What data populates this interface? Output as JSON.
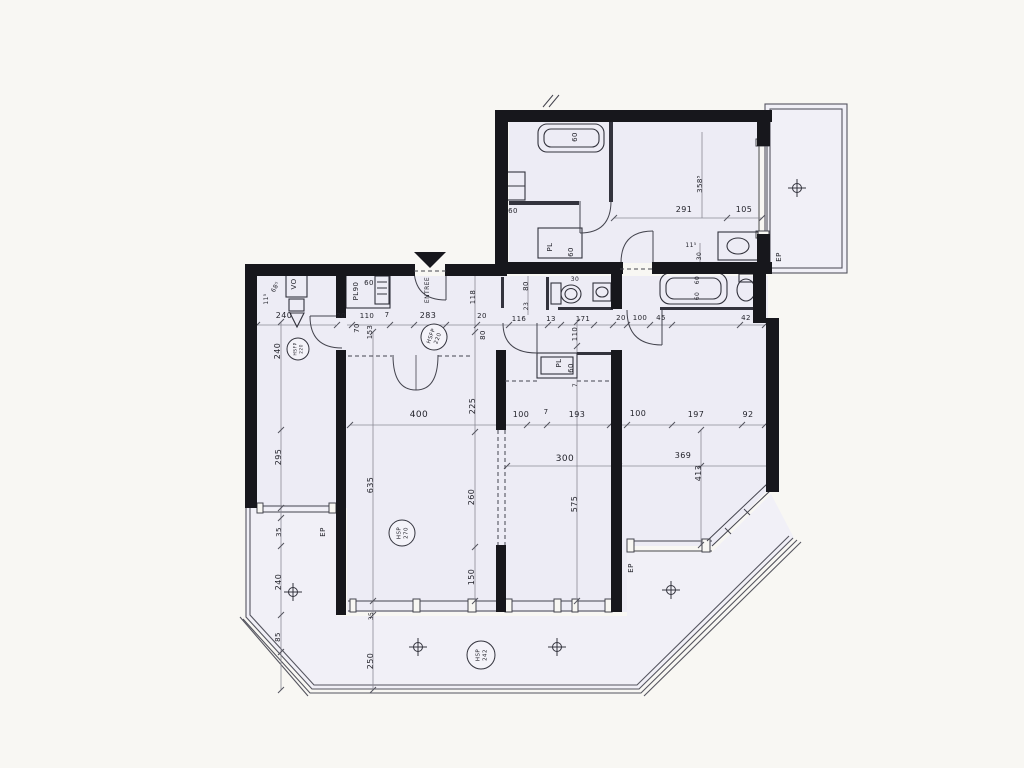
{
  "document": {
    "kind": "scanned apartment floor plan"
  },
  "colors": {
    "paper": "#f8f7f3",
    "room_fill": "#edecf5",
    "balcony_fill": "#f1f0f7",
    "wall": "#17171c",
    "line": "#44444e",
    "dim_line": "#8a8a95",
    "text": "#23232b",
    "watermark": "#7d7d88"
  },
  "plan": {
    "labels": [
      {
        "text": "60",
        "x": 577,
        "y": 137,
        "r": -90,
        "s": 7
      },
      {
        "text": "60",
        "x": 513,
        "y": 213,
        "r": 0,
        "s": 7
      },
      {
        "text": "PL",
        "x": 552,
        "y": 247,
        "r": -90,
        "s": 7
      },
      {
        "text": "60",
        "x": 573,
        "y": 252,
        "r": -90,
        "s": 7
      },
      {
        "text": "358⁵",
        "x": 702,
        "y": 184,
        "r": -90,
        "s": 7
      },
      {
        "text": "291",
        "x": 684,
        "y": 212,
        "r": 0,
        "s": 8
      },
      {
        "text": "105",
        "x": 744,
        "y": 212,
        "r": 0,
        "s": 8
      },
      {
        "text": "11⁵",
        "x": 691,
        "y": 247,
        "r": 0,
        "s": 6
      },
      {
        "text": "30",
        "x": 701,
        "y": 256,
        "r": -90,
        "s": 6
      },
      {
        "text": "EP",
        "x": 781,
        "y": 257,
        "r": -90,
        "s": 7
      },
      {
        "text": "60",
        "x": 699,
        "y": 280,
        "r": -90,
        "s": 6
      },
      {
        "text": "60",
        "x": 699,
        "y": 296,
        "r": -90,
        "s": 6
      },
      {
        "text": "30",
        "x": 575,
        "y": 281,
        "r": 0,
        "s": 6
      },
      {
        "text": "240",
        "x": 284,
        "y": 318,
        "r": 0,
        "s": 8
      },
      {
        "text": "20",
        "x": 341,
        "y": 318,
        "r": 0,
        "s": 7
      },
      {
        "text": "110",
        "x": 367,
        "y": 318,
        "r": 0,
        "s": 7
      },
      {
        "text": "7",
        "x": 387,
        "y": 317,
        "r": 0,
        "s": 7
      },
      {
        "text": "283",
        "x": 428,
        "y": 318,
        "r": 0,
        "s": 8
      },
      {
        "text": "20",
        "x": 482,
        "y": 318,
        "r": 0,
        "s": 7
      },
      {
        "text": "116",
        "x": 519,
        "y": 321,
        "r": 0,
        "s": 7
      },
      {
        "text": "13",
        "x": 551,
        "y": 321,
        "r": 0,
        "s": 7
      },
      {
        "text": "171",
        "x": 583,
        "y": 321,
        "r": 0,
        "s": 7
      },
      {
        "text": "20",
        "x": 621,
        "y": 320,
        "r": 0,
        "s": 7
      },
      {
        "text": "100",
        "x": 640,
        "y": 320,
        "r": 0,
        "s": 7
      },
      {
        "text": "45",
        "x": 661,
        "y": 320,
        "r": 0,
        "s": 7
      },
      {
        "text": "42",
        "x": 746,
        "y": 320,
        "r": 0,
        "s": 7
      },
      {
        "text": "70",
        "x": 359,
        "y": 328,
        "r": -90,
        "s": 7
      },
      {
        "text": "153",
        "x": 372,
        "y": 332,
        "r": -90,
        "s": 7
      },
      {
        "text": "118",
        "x": 475,
        "y": 297,
        "r": -90,
        "s": 7
      },
      {
        "text": "80",
        "x": 485,
        "y": 335,
        "r": -90,
        "s": 7
      },
      {
        "text": "80",
        "x": 528,
        "y": 286,
        "r": -90,
        "s": 7
      },
      {
        "text": "23",
        "x": 528,
        "y": 306,
        "r": -90,
        "s": 6
      },
      {
        "text": "110",
        "x": 577,
        "y": 334,
        "r": -90,
        "s": 7
      },
      {
        "text": "VO",
        "x": 296,
        "y": 284,
        "r": -90,
        "s": 7
      },
      {
        "text": "68⁵",
        "x": 277,
        "y": 288,
        "r": -60,
        "s": 6
      },
      {
        "text": "11⁵",
        "x": 268,
        "y": 299,
        "r": -90,
        "s": 6
      },
      {
        "text": "PL90",
        "x": 358,
        "y": 291,
        "r": -90,
        "s": 7
      },
      {
        "text": "60",
        "x": 369,
        "y": 285,
        "r": 0,
        "s": 7
      },
      {
        "text": "ENTREE",
        "x": 429,
        "y": 290,
        "r": -90,
        "s": 6
      },
      {
        "text": "PL",
        "x": 561,
        "y": 363,
        "r": -90,
        "s": 7
      },
      {
        "text": "60",
        "x": 573,
        "y": 368,
        "r": -90,
        "s": 7
      },
      {
        "text": "7",
        "x": 577,
        "y": 385,
        "r": -90,
        "s": 6
      },
      {
        "text": "225",
        "x": 475,
        "y": 406,
        "r": -90,
        "s": 8
      },
      {
        "text": "400",
        "x": 419,
        "y": 417,
        "r": 0,
        "s": 9
      },
      {
        "text": "100",
        "x": 521,
        "y": 417,
        "r": 0,
        "s": 8
      },
      {
        "text": "7",
        "x": 546,
        "y": 414,
        "r": 0,
        "s": 7
      },
      {
        "text": "193",
        "x": 577,
        "y": 417,
        "r": 0,
        "s": 8
      },
      {
        "text": "100",
        "x": 638,
        "y": 416,
        "r": 0,
        "s": 8
      },
      {
        "text": "197",
        "x": 696,
        "y": 417,
        "r": 0,
        "s": 8
      },
      {
        "text": "92",
        "x": 748,
        "y": 417,
        "r": 0,
        "s": 8
      },
      {
        "text": "300",
        "x": 565,
        "y": 461,
        "r": 0,
        "s": 9
      },
      {
        "text": "369",
        "x": 683,
        "y": 458,
        "r": 0,
        "s": 8
      },
      {
        "text": "413",
        "x": 701,
        "y": 473,
        "r": -90,
        "s": 8
      },
      {
        "text": "295",
        "x": 281,
        "y": 457,
        "r": -90,
        "s": 8
      },
      {
        "text": "240",
        "x": 280,
        "y": 351,
        "r": -90,
        "s": 8
      },
      {
        "text": "635",
        "x": 373,
        "y": 485,
        "r": -90,
        "s": 8
      },
      {
        "text": "260",
        "x": 474,
        "y": 497,
        "r": -90,
        "s": 8
      },
      {
        "text": "575",
        "x": 577,
        "y": 504,
        "r": -90,
        "s": 8
      },
      {
        "text": "150",
        "x": 474,
        "y": 577,
        "r": -90,
        "s": 8
      },
      {
        "text": "35",
        "x": 281,
        "y": 532,
        "r": -90,
        "s": 7
      },
      {
        "text": "EP",
        "x": 325,
        "y": 532,
        "r": -90,
        "s": 7
      },
      {
        "text": "240",
        "x": 281,
        "y": 582,
        "r": -90,
        "s": 8
      },
      {
        "text": "85",
        "x": 280,
        "y": 637,
        "r": -90,
        "s": 7
      },
      {
        "text": "35",
        "x": 373,
        "y": 616,
        "r": -90,
        "s": 6
      },
      {
        "text": "250",
        "x": 373,
        "y": 661,
        "r": -90,
        "s": 8
      },
      {
        "text": "EP",
        "x": 633,
        "y": 568,
        "r": -90,
        "s": 7
      }
    ],
    "badges": [
      {
        "line1": "HSFP",
        "line2": "220",
        "x": 298,
        "y": 349,
        "rad": 11,
        "r": -90,
        "fs": 4.5
      },
      {
        "line1": "HSFP",
        "line2": "220",
        "x": 434,
        "y": 337,
        "rad": 13,
        "r": -70,
        "fs": 5.5
      },
      {
        "line1": "HSP",
        "line2": "270",
        "x": 402,
        "y": 533,
        "rad": 13,
        "r": -90,
        "fs": 5.5
      },
      {
        "line1": "HSP",
        "line2": "242",
        "x": 481,
        "y": 655,
        "rad": 14,
        "r": -90,
        "fs": 5.5
      }
    ],
    "crosshairs": [
      {
        "x": 797,
        "y": 188
      },
      {
        "x": 293,
        "y": 592
      },
      {
        "x": 418,
        "y": 647
      },
      {
        "x": 557,
        "y": 647
      },
      {
        "x": 671,
        "y": 590
      }
    ]
  }
}
